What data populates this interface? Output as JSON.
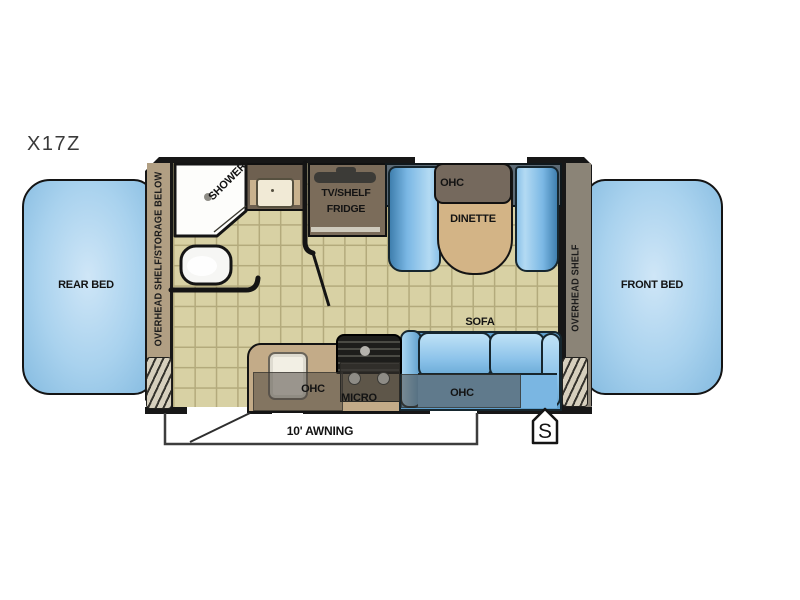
{
  "title": "X17Z",
  "plan": {
    "rear_bed_label": "REAR BED",
    "front_bed_label": "FRONT BED",
    "left_wall_label": "OVERHEAD SHELF/STORAGE BELOW",
    "right_wall_label": "OVERHEAD SHELF",
    "shower_label": "SHOWER",
    "tv_shelf_label": "TV/SHELF",
    "fridge_label": "FRIDGE",
    "dinette_ohc_label": "OHC",
    "dinette_label": "DINETTE",
    "sofa_label": "SOFA",
    "sofa_ohc_label": "OHC",
    "kitchen_ohc_label": "OHC",
    "micro_label": "MICRO",
    "awning_label": "10' AWNING",
    "spare_badge_label": "S"
  },
  "colors": {
    "bed_fill": "#a9d2ee",
    "bench_blue": "#7ab7e4",
    "floor": "#d8d1a4",
    "floor_grid": "#b3aa7c",
    "wall": "#171717",
    "left_band": "#b19f83",
    "right_band": "#8b8477",
    "cabinet_brown": "#7b6c5a",
    "counter_tan": "#c3ab88",
    "table_tan": "#d3b486",
    "dinette_back": "#5d6b76"
  }
}
